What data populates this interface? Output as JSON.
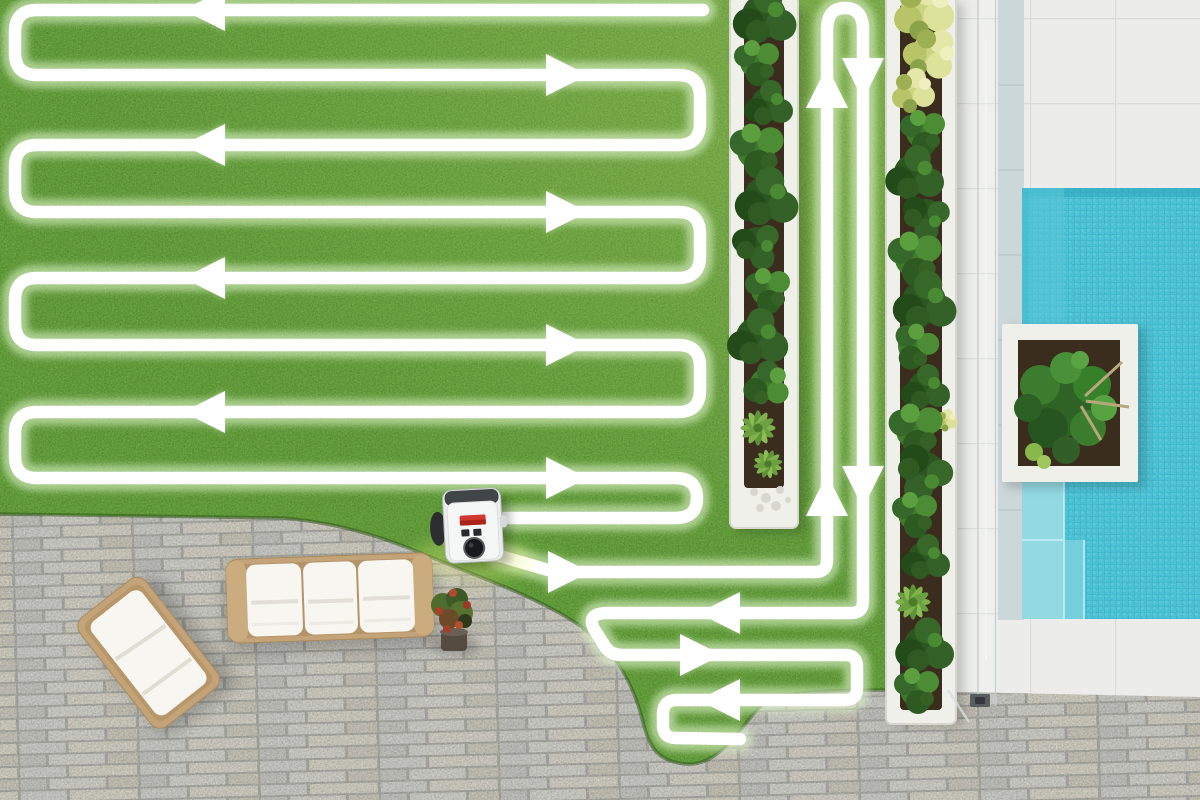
{
  "meta": {
    "title": "Aerial view of a robotic lawn mower's serpentine mowing route across a garden with patio and pool",
    "description": "Top-down photo: white glowing mowing path with direction arrows over a lawn, robot mower charging station at the lawn edge, stone patio with white outdoor sofa and lounge chair, two white-edged shrub beds, glass pool fence, white tiled deck, turquoise pool with corner steps and a white planter box."
  },
  "colors": {
    "grass": "#64a03c",
    "grass_dark": "#2f5c1d",
    "grass_light": "#9cc95e",
    "path": "#ffffff",
    "path_glow": "#dcf2c8",
    "patio_joint": "#a3a49e",
    "stone_a": "#c7c7c3",
    "stone_b": "#cecabf",
    "deck": "#ecedea",
    "deck_joint": "#dadcd8",
    "water": "#45bfd3",
    "water_step": "#93d9e2",
    "water_step2": "#74cedb",
    "coping": "#ccd7d9",
    "bed_white": "#f0f0ea",
    "soil": "#3a2d1e",
    "shrub_dark": "#2b5620",
    "shrub_mid": "#3f7a2b",
    "shrub_yellow": "#cdd47f",
    "frame_tan": "#c3a377",
    "cushion": "#f7f6f1",
    "glass_line": "#c5cccc",
    "station_body": "#ebecec",
    "station_top": "#404548",
    "station_red": "#d23730",
    "station_black": "#17191c",
    "station_glow": "#e9f77f",
    "flower_red": "#a84127"
  },
  "mow_path": {
    "stroke_width": 12.5,
    "glow_width": 26,
    "d": "M703,10 L37,10 Q15,10 15,32 L15,53 Q15,75 37,75 L678,75 Q700,75 700,97 L700,123 Q700,145 678,145 L37,145 Q15,145 15,167 L15,190 Q15,212 37,212 L678,212 Q700,212 700,234 L700,256 Q700,278 678,278 L37,278 Q15,278 15,300 L15,323 Q15,345 37,345 L678,345 Q700,345 700,367 L700,390 Q700,412 678,412 L37,412 Q15,412 15,434 L15,456 Q15,478 37,478 L675,478 Q697,478 697,498 Q697,518 675,518 L505,518 M500,556 L548,570 Q557,572 566,572 L815,572 Q827,572 827,560 L827,30 Q827,8 845,8 Q863,8 863,30 L863,601 Q863,613 851,613 L608,613 Q586,613 594,629 L606,648 Q612,655 622,655 L845,655 Q857,655 857,667 L857,688 Q857,700 845,700 L677,700 Q663,700 663,714 L663,725 Q663,738 676,738 L740,739",
    "arrows": [
      {
        "dir": "W",
        "x": 183,
        "y": 10
      },
      {
        "dir": "E",
        "x": 588,
        "y": 75
      },
      {
        "dir": "W",
        "x": 183,
        "y": 145
      },
      {
        "dir": "E",
        "x": 588,
        "y": 212
      },
      {
        "dir": "W",
        "x": 183,
        "y": 278
      },
      {
        "dir": "E",
        "x": 588,
        "y": 345
      },
      {
        "dir": "W",
        "x": 183,
        "y": 412
      },
      {
        "dir": "E",
        "x": 588,
        "y": 478
      },
      {
        "dir": "E",
        "x": 590,
        "y": 572
      },
      {
        "dir": "N",
        "x": 827,
        "y": 66
      },
      {
        "dir": "S",
        "x": 863,
        "y": 100
      },
      {
        "dir": "N",
        "x": 827,
        "y": 474
      },
      {
        "dir": "S",
        "x": 863,
        "y": 508
      },
      {
        "dir": "W",
        "x": 698,
        "y": 613
      },
      {
        "dir": "E",
        "x": 722,
        "y": 655
      },
      {
        "dir": "W",
        "x": 698,
        "y": 700
      }
    ]
  },
  "objects": {
    "lawn": {
      "label": "lawn with mowing route"
    },
    "station": {
      "label": "robotic mower charging station"
    },
    "sofa": {
      "label": "white outdoor sofa"
    },
    "lounge_chair": {
      "label": "white lounge chair"
    },
    "potted_plant": {
      "label": "potted plant with red flowers"
    },
    "bed_left": {
      "label": "shrub border bed"
    },
    "bed_right": {
      "label": "shrub border bed"
    },
    "patio": {
      "label": "stone paver patio"
    },
    "deck": {
      "label": "white tiled pool deck"
    },
    "pool": {
      "label": "turquoise swimming pool"
    },
    "planter": {
      "label": "white pool planter box"
    },
    "glass_fence": {
      "label": "glass pool fence"
    }
  }
}
